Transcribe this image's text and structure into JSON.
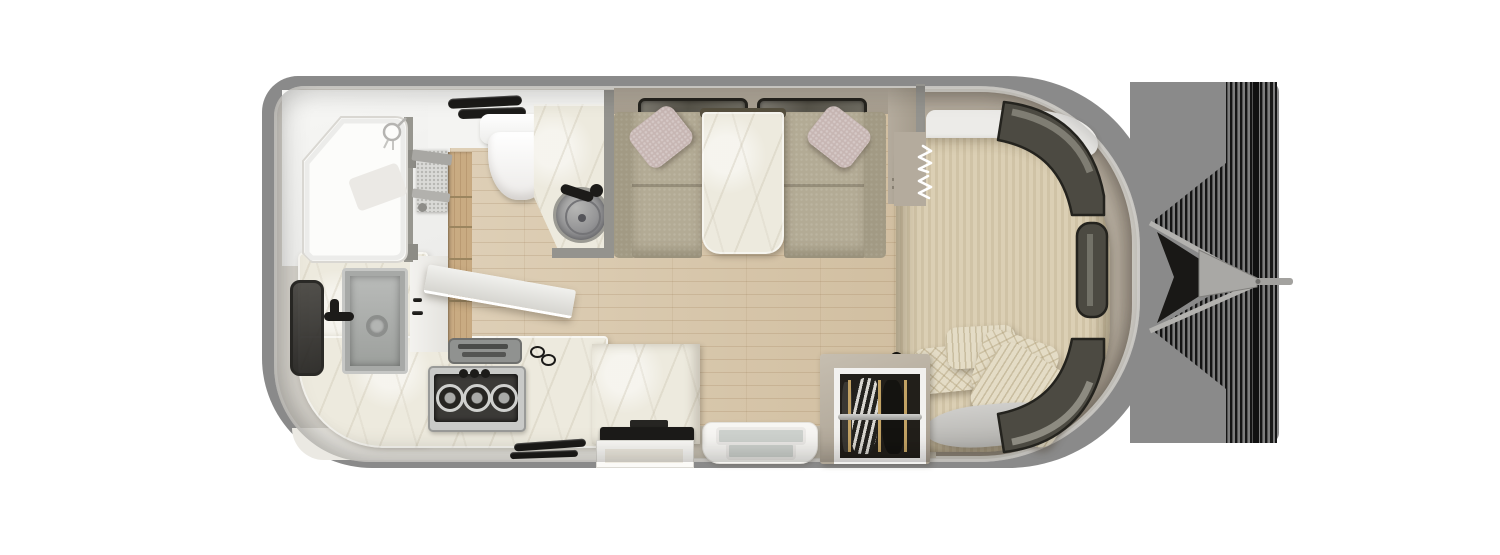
{
  "canvas": {
    "width": 1500,
    "height": 555
  },
  "palette": {
    "page_bg": "#ffffff",
    "silhouette": "#8a8a8a",
    "shell_rim": "#d4d1ca",
    "shell_wall": "#cbc7bd",
    "wall_taupe": "#b4ab9d",
    "wall_taupe_dark": "#a59c8d",
    "floor_wood": "#d7c5a7",
    "floor_taupe": "#c7c0b2",
    "wood_cabinet": "#c9ab82",
    "marble": "#edeade",
    "bath_white": "#f4f4f2",
    "gray_wall": "#94938e",
    "window_dark": "#4c4a42",
    "window_frame": "#26241f",
    "fabric_olive": "#b3ab95",
    "fabric_olive_dark": "#a29a84",
    "pillow_mauve": "#c7b6b3",
    "bed_stripe_a": "#dbcfb4",
    "bed_stripe_b": "#d0c3a6",
    "knit": "#e4dcc6",
    "runner_gray": "#c5c4c0",
    "steel": "#c0c1bf",
    "steel_dark": "#8f908e",
    "black": "#1c1b19",
    "hood_white": "#f1f1ee",
    "door_pane": "#ced2ce",
    "wardrobe_dark": "#221f1a",
    "rail_gray": "#b9b8b4",
    "hanger_tan": "#c2a264",
    "beam_gray": "#b3b2af",
    "stripe_dark": "#141414"
  },
  "scene": {
    "type": "travel-trailer floor plan, top-down 3D render",
    "areas": [
      {
        "name": "rear-bath",
        "fixtures": [
          "shower",
          "shower-door",
          "toilet",
          "towel-bars",
          "vanity-counter",
          "vessel-sink",
          "bath-faucet"
        ]
      },
      {
        "name": "galley-kitchen",
        "fixtures": [
          "side-window",
          "kitchen-sink",
          "kitchen-faucet",
          "pantry",
          "wood-cabinet-column",
          "range-hood",
          "recessed-tray",
          "utensil-hooks",
          "three-burner-cooktop",
          "burner-knobs",
          "drawer-handles",
          "lower-cabinet-band"
        ]
      },
      {
        "name": "dinette",
        "fixtures": [
          "window-left",
          "window-right",
          "bench-left",
          "bench-right",
          "throw-pillow-left",
          "throw-pillow-right",
          "dining-table"
        ]
      },
      {
        "name": "bedroom",
        "fixtures": [
          "bed",
          "headboard-shelf",
          "knit-pillow-1",
          "ribbed-pillow-2",
          "knit-pillow-3",
          "ribbed-pillow-4",
          "throw-runner",
          "wardrobe",
          "clothes-rail",
          "hanging-garments",
          "curved-window-top",
          "side-window-front",
          "curved-window-bottom",
          "privacy-curtain-symbol",
          "wall-shelves"
        ]
      },
      {
        "name": "entry",
        "fixtures": [
          "entry-door",
          "tv-cabinet",
          "tv",
          "drawer-unit"
        ]
      },
      {
        "name": "hitch",
        "fixtures": [
          "a-frame-beam-upper",
          "a-frame-beam-lower",
          "coupler",
          "tow-rod",
          "striped-shade-band",
          "striped-shade-triangles"
        ]
      }
    ]
  }
}
